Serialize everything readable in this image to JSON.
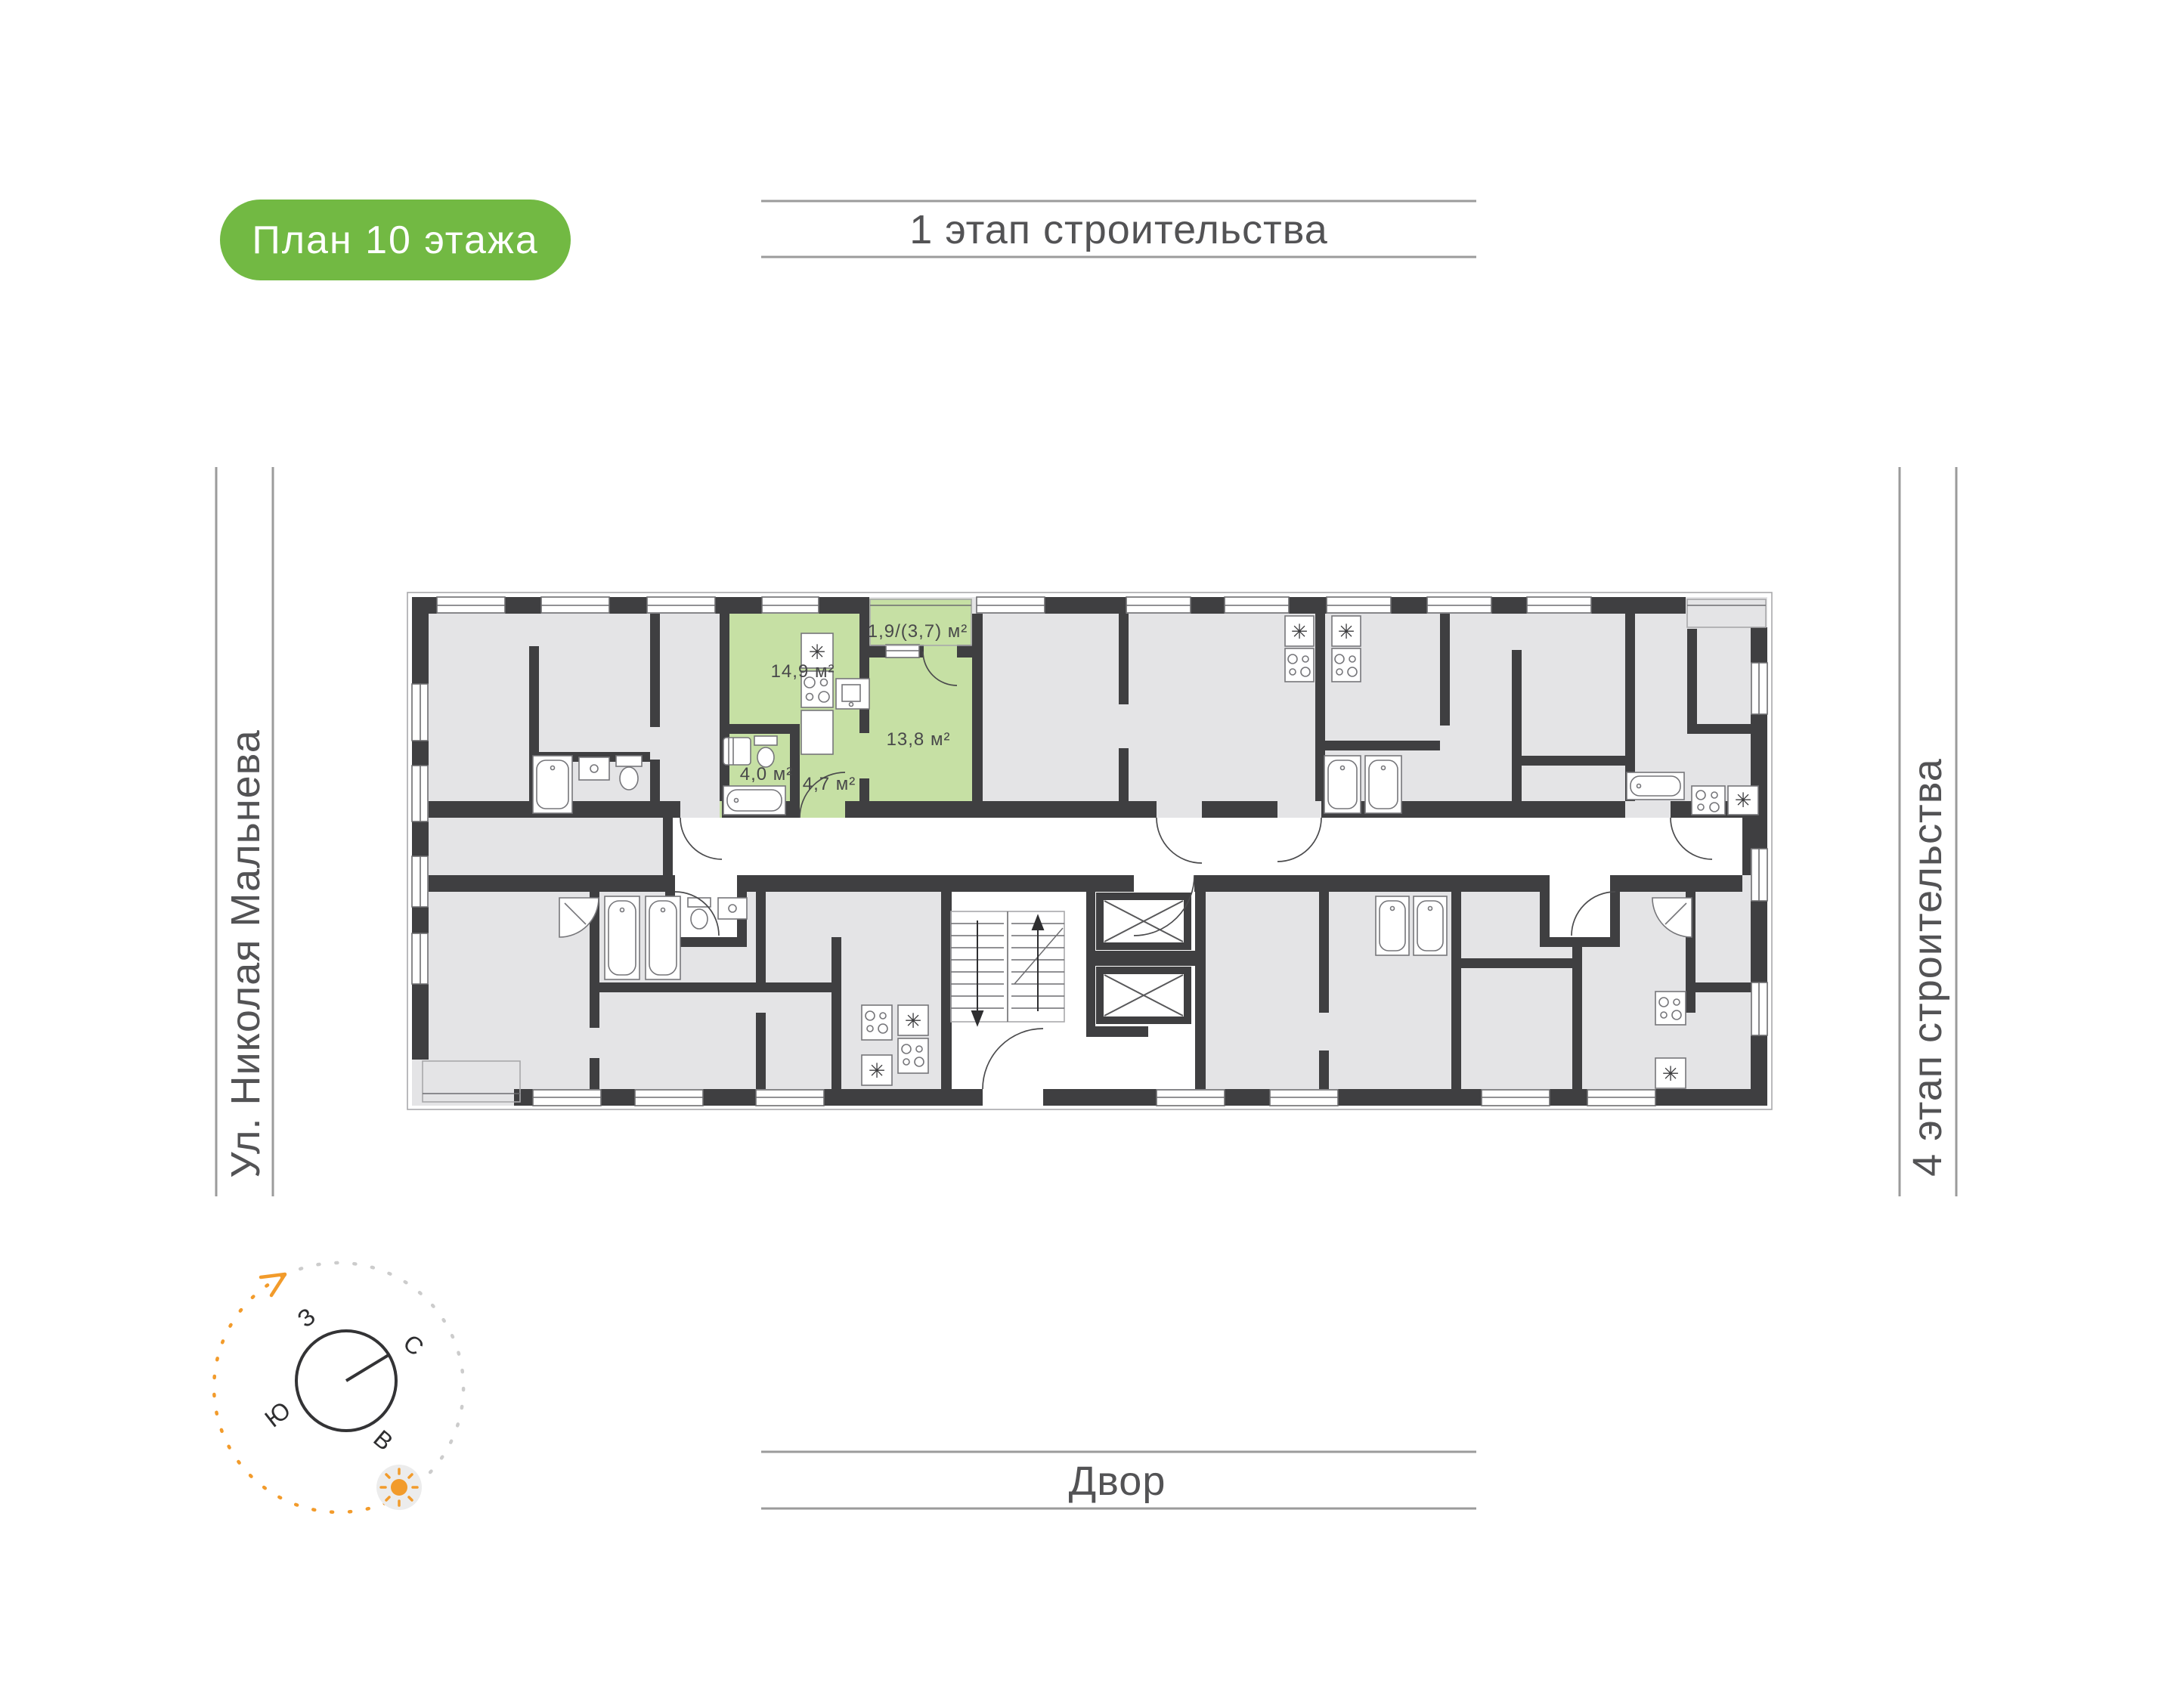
{
  "badge": {
    "label": "План 10 этажа"
  },
  "banners": {
    "top": "1 этап строительства",
    "bottom": "Двор",
    "left": "Ул. Николая Мальнева",
    "right": "4 этап строительства"
  },
  "compass": {
    "west": "З",
    "north": "С",
    "south": "Ю",
    "east": "В"
  },
  "apartment": {
    "areas": [
      {
        "name": "kitchen-living",
        "label": "14,9 м²"
      },
      {
        "name": "balcony",
        "label": "1,9/(3,7) м²"
      },
      {
        "name": "room",
        "label": "13,8 м²"
      },
      {
        "name": "bathroom",
        "label": "4,0 м²"
      },
      {
        "name": "hallway",
        "label": "4,7 м²"
      }
    ]
  },
  "icons": {
    "fridge": "✳",
    "sun": "sun"
  },
  "colors": {
    "badge_green": "#72b943",
    "highlight_green": "#c6e0a4",
    "wall": "#3f3f41",
    "room": "#e4e4e6",
    "accent_orange": "#f29b2b",
    "line_gray": "#9b9b9b",
    "text_gray": "#535355"
  }
}
